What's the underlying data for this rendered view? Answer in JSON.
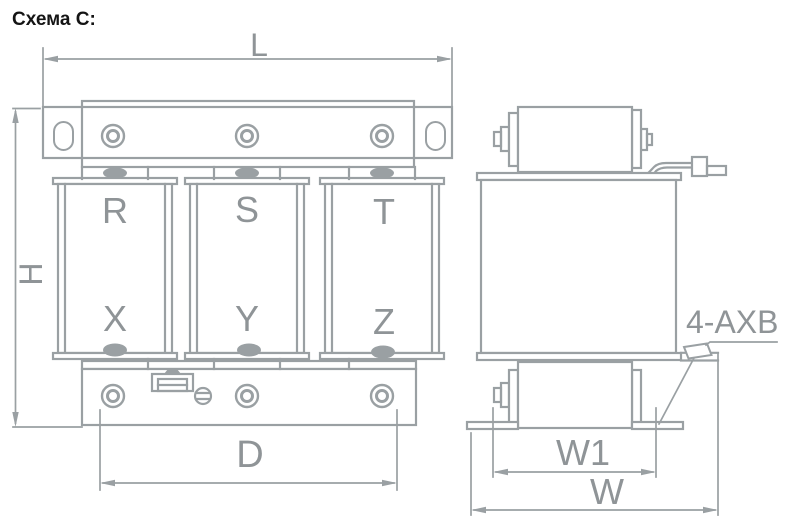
{
  "title": "Схема C:",
  "colors": {
    "line": "#9aa0a3",
    "label": "#8f9497",
    "title": "#141414",
    "background": "#ffffff"
  },
  "front_view": {
    "dimensions": {
      "length": "L",
      "height": "H",
      "mounting_spacing": "D"
    },
    "coils": [
      {
        "top": "R",
        "bottom": "X"
      },
      {
        "top": "S",
        "bottom": "Y"
      },
      {
        "top": "T",
        "bottom": "Z"
      }
    ]
  },
  "side_view": {
    "dimensions": {
      "foot_hole_spacing": "W1",
      "width": "W"
    },
    "mounting_holes_note": "4-AXB"
  }
}
